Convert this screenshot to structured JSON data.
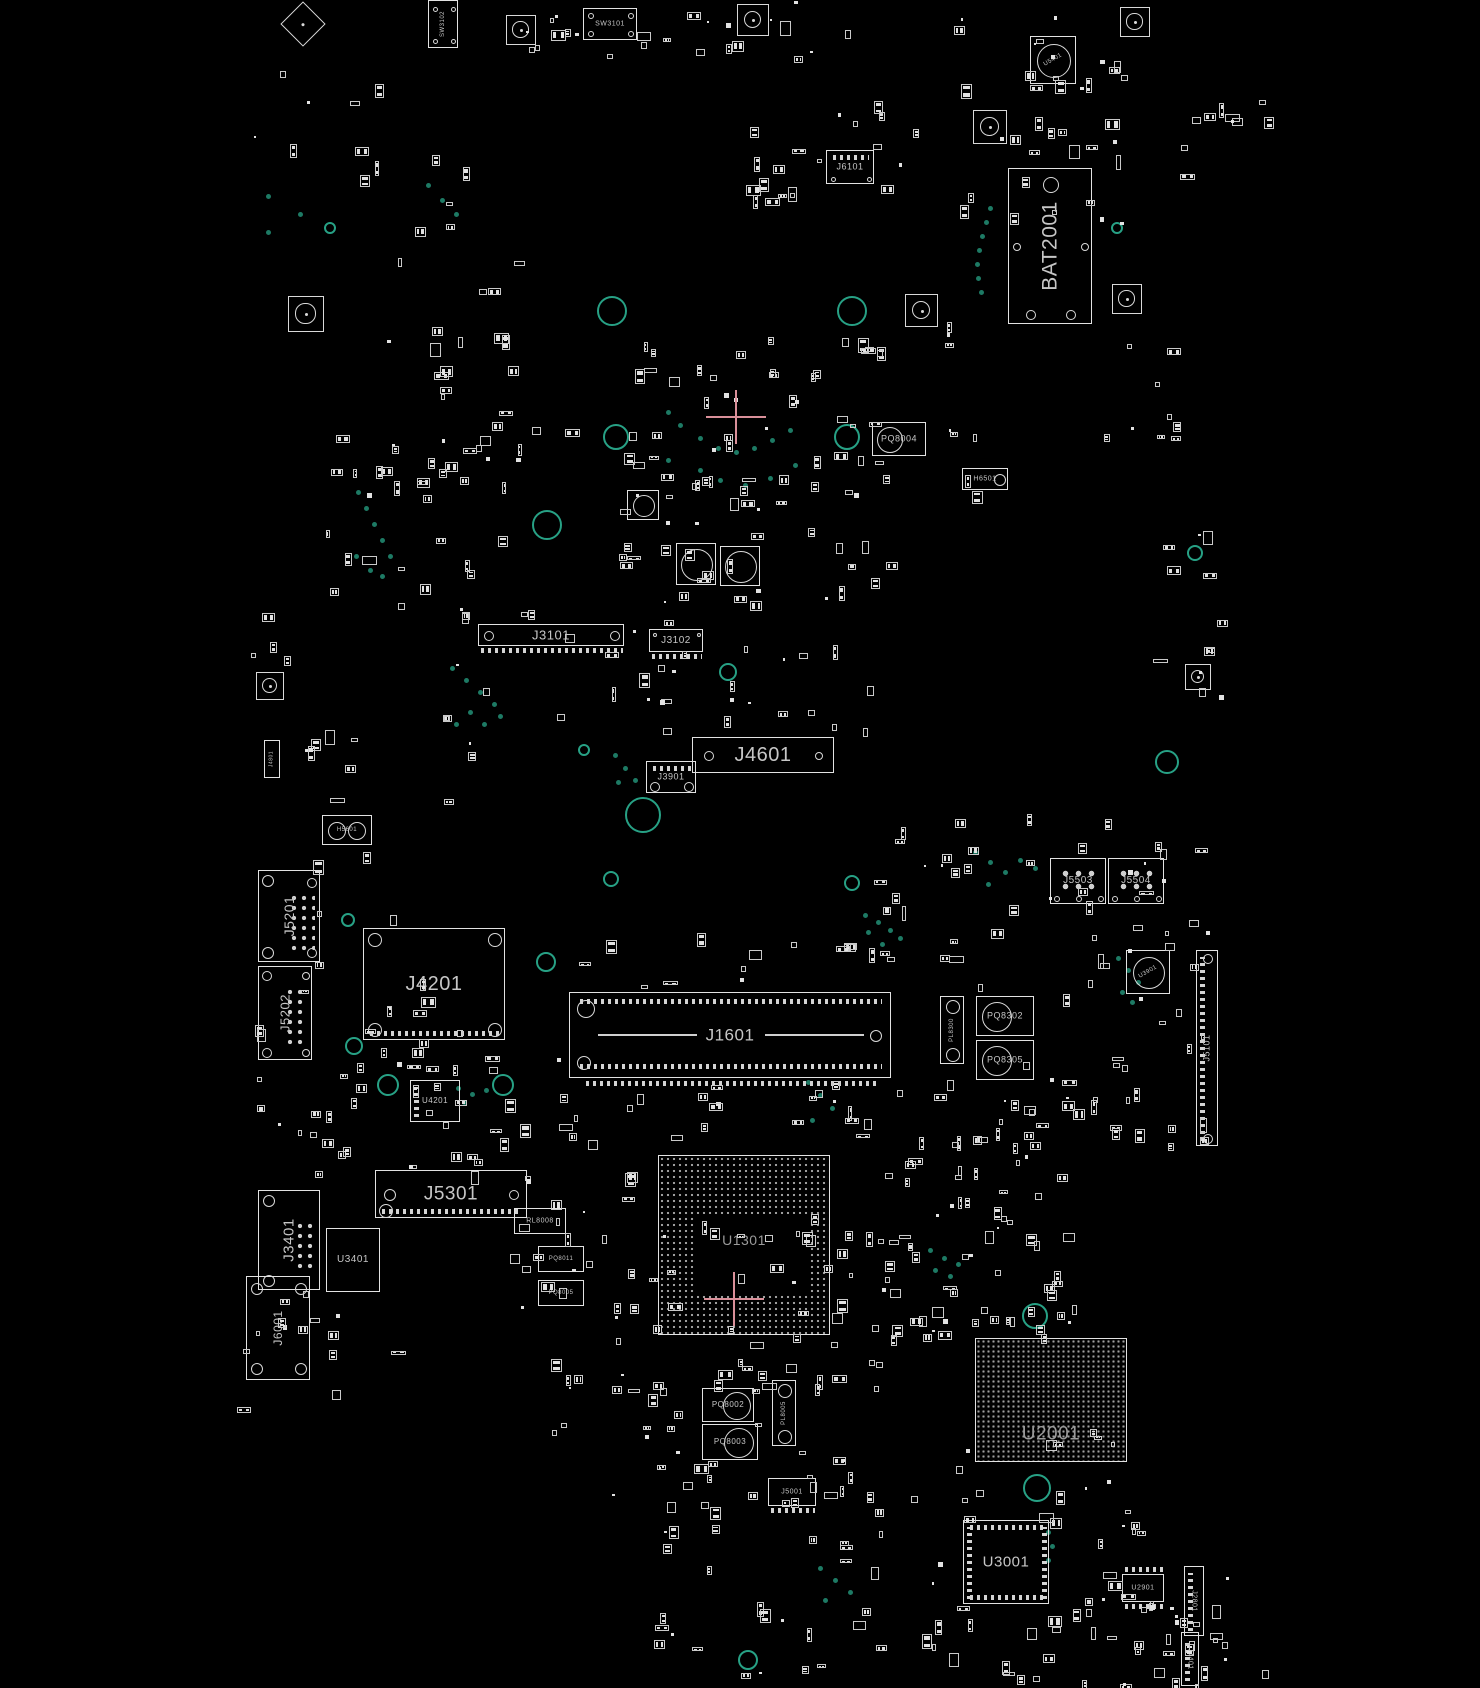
{
  "view": {
    "description": "PCB boardview component placement diagram, black background with white component outlines",
    "width": 1480,
    "height": 1688
  },
  "colors": {
    "background": "#000000",
    "outline": "#e2e2e2",
    "label": "#c6c6c6",
    "label_dim": "#9a9a9a",
    "via_teal": "#1d7a64",
    "ring_teal": "#27a185",
    "bga_dot": "#9f9f9f",
    "crosshair_pink": "#d98f99"
  },
  "components": [
    {
      "label": "SW3102",
      "x": 428,
      "y": 0,
      "w": 30,
      "h": 48,
      "fs": 6,
      "rot": -90,
      "holes": [
        [
          6,
          8,
          2.5
        ],
        [
          24,
          8,
          2.5
        ],
        [
          6,
          40,
          2.5
        ],
        [
          24,
          40,
          2.5
        ]
      ]
    },
    {
      "label": "SW3101",
      "x": 583,
      "y": 8,
      "w": 54,
      "h": 32,
      "fs": 7,
      "rot": 0,
      "holes": [
        [
          7,
          7,
          3
        ],
        [
          47,
          7,
          3
        ],
        [
          7,
          25,
          3
        ],
        [
          47,
          25,
          3
        ]
      ]
    },
    {
      "label": "J6101",
      "x": 826,
      "y": 150,
      "w": 48,
      "h": 34,
      "fs": 9,
      "rot": 0,
      "pins": [
        "top"
      ],
      "holes": [
        [
          6,
          28,
          2.5
        ],
        [
          42,
          28,
          2.5
        ]
      ]
    },
    {
      "label": "U5401",
      "x": 1030,
      "y": 36,
      "w": 46,
      "h": 48,
      "fs": 6,
      "rot": -30,
      "circles": [
        [
          23,
          24,
          17
        ]
      ]
    },
    {
      "label": "BAT2001",
      "x": 1008,
      "y": 168,
      "w": 84,
      "h": 156,
      "fs": 21,
      "rot": -90,
      "holes": [
        [
          42,
          16,
          8
        ],
        [
          8,
          78,
          4
        ],
        [
          76,
          78,
          4
        ],
        [
          22,
          146,
          5
        ],
        [
          62,
          146,
          5
        ]
      ]
    },
    {
      "label": "PQ8004",
      "x": 872,
      "y": 422,
      "w": 54,
      "h": 34,
      "fs": 9,
      "rot": 0,
      "circles": [
        [
          17,
          17,
          13
        ]
      ]
    },
    {
      "label": "H6501",
      "x": 962,
      "y": 468,
      "w": 46,
      "h": 22,
      "fs": 7,
      "rot": 0,
      "circles": [
        [
          37,
          11,
          6
        ]
      ]
    },
    {
      "label": "J3101",
      "x": 478,
      "y": 624,
      "w": 146,
      "h": 22,
      "fs": 13,
      "rot": 0,
      "holes": [
        [
          10,
          11,
          5
        ],
        [
          136,
          11,
          5
        ]
      ],
      "pins": [
        "bottom-out"
      ]
    },
    {
      "label": "J3102",
      "x": 649,
      "y": 629,
      "w": 54,
      "h": 23,
      "fs": 10,
      "rot": 0,
      "pins": [
        "bottom-out"
      ],
      "holes": [
        [
          5,
          5,
          2
        ],
        [
          49,
          5,
          2
        ]
      ]
    },
    {
      "label": "J4601",
      "x": 692,
      "y": 737,
      "w": 142,
      "h": 36,
      "fs": 20,
      "rot": 0,
      "holes": [
        [
          16,
          18,
          5
        ],
        [
          126,
          18,
          4
        ]
      ]
    },
    {
      "label": "J3901",
      "x": 646,
      "y": 761,
      "w": 50,
      "h": 32,
      "fs": 9,
      "rot": 0,
      "pins": [
        "top"
      ],
      "holes": [
        [
          8,
          25,
          5
        ],
        [
          42,
          25,
          5
        ]
      ]
    },
    {
      "label": "H5601",
      "x": 322,
      "y": 815,
      "w": 50,
      "h": 30,
      "fs": 6,
      "rot": 0,
      "circles": [
        [
          14,
          15,
          9
        ],
        [
          34,
          15,
          9
        ]
      ]
    },
    {
      "label": "J5201",
      "x": 258,
      "y": 870,
      "w": 62,
      "h": 92,
      "fs": 14,
      "rot": -90,
      "holes": [
        [
          9,
          10,
          6
        ],
        [
          53,
          12,
          5
        ],
        [
          9,
          82,
          6
        ],
        [
          53,
          82,
          5
        ]
      ],
      "dots": [
        30,
        22,
        26,
        58,
        10,
        2
      ]
    },
    {
      "label": "J5202",
      "x": 258,
      "y": 966,
      "w": 54,
      "h": 94,
      "fs": 13,
      "rot": -90,
      "holes": [
        [
          8,
          9,
          5
        ],
        [
          47,
          9,
          4
        ],
        [
          8,
          86,
          5
        ],
        [
          47,
          86,
          4
        ]
      ],
      "dots": [
        26,
        20,
        22,
        60,
        10,
        2
      ]
    },
    {
      "label": "J4201",
      "x": 363,
      "y": 928,
      "w": 142,
      "h": 112,
      "fs": 20,
      "rot": 0,
      "holes": [
        [
          11,
          11,
          7
        ],
        [
          131,
          11,
          7
        ],
        [
          11,
          101,
          7
        ],
        [
          131,
          101,
          7
        ]
      ],
      "pins": [
        "bottom"
      ]
    },
    {
      "label": "U4201",
      "x": 410,
      "y": 1080,
      "w": 50,
      "h": 42,
      "fs": 8,
      "rot": 0,
      "pins": [
        "left"
      ]
    },
    {
      "label": "J1601",
      "x": 569,
      "y": 992,
      "w": 322,
      "h": 86,
      "fs": 17,
      "rot": 0,
      "kind": "dimm",
      "holes": [
        [
          16,
          16,
          9
        ],
        [
          306,
          43,
          6
        ],
        [
          14,
          70,
          7
        ]
      ]
    },
    {
      "label": "J5503",
      "x": 1050,
      "y": 858,
      "w": 56,
      "h": 46,
      "fs": 10,
      "rot": 0,
      "dots": [
        8,
        8,
        40,
        26,
        13,
        2.6
      ],
      "holes": [
        [
          6,
          40,
          3
        ],
        [
          28,
          40,
          3
        ],
        [
          50,
          40,
          3
        ]
      ]
    },
    {
      "label": "J5504",
      "x": 1108,
      "y": 858,
      "w": 56,
      "h": 46,
      "fs": 10,
      "rot": 0,
      "dots": [
        8,
        8,
        40,
        26,
        13,
        2.6
      ],
      "holes": [
        [
          6,
          40,
          3
        ],
        [
          28,
          40,
          3
        ],
        [
          50,
          40,
          3
        ]
      ]
    },
    {
      "label": "U3901",
      "x": 1126,
      "y": 950,
      "w": 44,
      "h": 44,
      "fs": 6,
      "rot": -30,
      "circles": [
        [
          22,
          22,
          16
        ]
      ]
    },
    {
      "label": "PL8300",
      "x": 940,
      "y": 996,
      "w": 24,
      "h": 68,
      "fs": 6,
      "rot": -90,
      "circles": [
        [
          12,
          10,
          7
        ],
        [
          12,
          58,
          7
        ]
      ]
    },
    {
      "label": "PQ8302",
      "x": 976,
      "y": 996,
      "w": 58,
      "h": 40,
      "fs": 9,
      "rot": 0,
      "circles": [
        [
          20,
          20,
          15
        ]
      ]
    },
    {
      "label": "PQ8305",
      "x": 976,
      "y": 1040,
      "w": 58,
      "h": 40,
      "fs": 9,
      "rot": 0,
      "circles": [
        [
          20,
          20,
          15
        ]
      ]
    },
    {
      "label": "J5101",
      "x": 1196,
      "y": 950,
      "w": 22,
      "h": 196,
      "fs": 9,
      "rot": -90,
      "holes": [
        [
          11,
          8,
          5
        ],
        [
          11,
          188,
          5
        ]
      ],
      "pins": [
        "left"
      ]
    },
    {
      "label": "J5301",
      "x": 375,
      "y": 1170,
      "w": 152,
      "h": 48,
      "fs": 19,
      "rot": 0,
      "holes": [
        [
          14,
          24,
          6
        ],
        [
          138,
          24,
          5
        ],
        [
          10,
          40,
          7
        ]
      ],
      "pins": [
        "bottom"
      ]
    },
    {
      "label": "RL8008",
      "x": 514,
      "y": 1208,
      "w": 52,
      "h": 26,
      "fs": 7,
      "rot": 0
    },
    {
      "label": "PQ8011",
      "x": 538,
      "y": 1246,
      "w": 46,
      "h": 26,
      "fs": 6,
      "rot": 0
    },
    {
      "label": "PQ8005",
      "x": 538,
      "y": 1280,
      "w": 46,
      "h": 26,
      "fs": 6,
      "rot": 0
    },
    {
      "label": "J3401",
      "x": 258,
      "y": 1190,
      "w": 62,
      "h": 100,
      "fs": 15,
      "rot": -90,
      "holes": [
        [
          10,
          10,
          6
        ],
        [
          10,
          90,
          6
        ]
      ],
      "dots": [
        36,
        30,
        20,
        50,
        10,
        2
      ]
    },
    {
      "label": "U3401",
      "x": 326,
      "y": 1228,
      "w": 54,
      "h": 64,
      "fs": 10,
      "rot": 0
    },
    {
      "label": "J6001",
      "x": 246,
      "y": 1276,
      "w": 64,
      "h": 104,
      "fs": 12,
      "rot": -90,
      "holes": [
        [
          10,
          12,
          6
        ],
        [
          54,
          12,
          6
        ],
        [
          10,
          92,
          6
        ],
        [
          54,
          92,
          6
        ]
      ]
    },
    {
      "label": "U1301",
      "x": 658,
      "y": 1155,
      "w": 172,
      "h": 180,
      "fs": 14,
      "rot": 0,
      "kind": "bga1"
    },
    {
      "label": "U2001",
      "x": 975,
      "y": 1338,
      "w": 152,
      "h": 124,
      "fs": 19,
      "rot": 0,
      "kind": "bga2"
    },
    {
      "label": "U3001",
      "x": 963,
      "y": 1520,
      "w": 86,
      "h": 84,
      "fs": 15,
      "rot": 0,
      "pins": [
        "top",
        "bottom",
        "left",
        "right"
      ]
    },
    {
      "label": "PQ8002",
      "x": 702,
      "y": 1388,
      "w": 52,
      "h": 34,
      "fs": 8,
      "rot": 0,
      "circles": [
        [
          34,
          17,
          14
        ]
      ]
    },
    {
      "label": "PQ8003",
      "x": 702,
      "y": 1424,
      "w": 56,
      "h": 36,
      "fs": 8,
      "rot": 0,
      "circles": [
        [
          36,
          18,
          15
        ]
      ]
    },
    {
      "label": "PL8005",
      "x": 772,
      "y": 1380,
      "w": 24,
      "h": 66,
      "fs": 6,
      "rot": -90,
      "circles": [
        [
          12,
          10,
          7
        ],
        [
          12,
          56,
          7
        ]
      ]
    },
    {
      "label": "J5001",
      "x": 768,
      "y": 1478,
      "w": 48,
      "h": 28,
      "fs": 7,
      "rot": 0,
      "pins": [
        "bottom-out"
      ]
    },
    {
      "label": "U2901",
      "x": 1122,
      "y": 1574,
      "w": 42,
      "h": 28,
      "fs": 7,
      "rot": 0,
      "pins": [
        "top-out",
        "bottom-out"
      ]
    },
    {
      "label": "J2801",
      "x": 1184,
      "y": 1566,
      "w": 20,
      "h": 70,
      "fs": 7,
      "rot": 90,
      "pins": [
        "left"
      ]
    },
    {
      "label": "J4401",
      "x": 1181,
      "y": 1632,
      "w": 18,
      "h": 54,
      "fs": 7,
      "rot": 90,
      "pins": [
        "left"
      ]
    },
    {
      "label": "J4801",
      "x": 264,
      "y": 740,
      "w": 16,
      "h": 38,
      "fs": 5,
      "rot": -90
    },
    {
      "label": "",
      "x": 676,
      "y": 543,
      "w": 40,
      "h": 42,
      "circles": [
        [
          20,
          21,
          16
        ]
      ]
    },
    {
      "label": "",
      "x": 720,
      "y": 546,
      "w": 40,
      "h": 40,
      "circles": [
        [
          20,
          20,
          16
        ]
      ]
    },
    {
      "label": "",
      "x": 627,
      "y": 490,
      "w": 32,
      "h": 30,
      "circles": [
        [
          16,
          15,
          11
        ]
      ]
    }
  ],
  "passive_clusters": [
    [
      520,
      0,
      330,
      58,
      24
    ],
    [
      735,
      95,
      190,
      108,
      20
    ],
    [
      938,
      14,
      185,
      212,
      36
    ],
    [
      1150,
      75,
      130,
      108,
      10
    ],
    [
      380,
      255,
      150,
      95,
      10
    ],
    [
      425,
      360,
      145,
      135,
      14
    ],
    [
      320,
      430,
      200,
      175,
      30
    ],
    [
      615,
      325,
      268,
      182,
      42
    ],
    [
      610,
      458,
      280,
      148,
      38
    ],
    [
      855,
      320,
      128,
      178,
      12
    ],
    [
      1085,
      335,
      95,
      135,
      9
    ],
    [
      1148,
      470,
      72,
      230,
      12
    ],
    [
      430,
      600,
      238,
      128,
      18
    ],
    [
      635,
      642,
      238,
      98,
      18
    ],
    [
      280,
      710,
      198,
      98,
      10
    ],
    [
      295,
      830,
      128,
      208,
      8
    ],
    [
      868,
      810,
      340,
      188,
      48
    ],
    [
      1090,
      1000,
      118,
      158,
      18
    ],
    [
      235,
      990,
      228,
      188,
      28
    ],
    [
      335,
      1050,
      238,
      128,
      20
    ],
    [
      510,
      1090,
      158,
      218,
      24
    ],
    [
      795,
      1050,
      278,
      278,
      52
    ],
    [
      550,
      1222,
      128,
      216,
      20
    ],
    [
      610,
      1322,
      278,
      208,
      40
    ],
    [
      868,
      1226,
      208,
      118,
      28
    ],
    [
      1030,
      1420,
      158,
      198,
      20
    ],
    [
      830,
      1440,
      148,
      218,
      26
    ],
    [
      946,
      1598,
      318,
      86,
      28
    ],
    [
      650,
      1460,
      168,
      224,
      24
    ],
    [
      235,
      1280,
      168,
      128,
      14
    ],
    [
      1082,
      1560,
      150,
      124,
      16
    ],
    [
      240,
      60,
      140,
      118,
      7
    ],
    [
      355,
      120,
      118,
      118,
      7
    ],
    [
      1010,
      1060,
      78,
      98,
      8
    ],
    [
      878,
      1128,
      118,
      88,
      12
    ],
    [
      250,
      598,
      44,
      80,
      4
    ],
    [
      560,
      930,
      320,
      56,
      14
    ],
    [
      640,
      1085,
      240,
      58,
      12
    ],
    [
      700,
      1218,
      112,
      70,
      9
    ]
  ],
  "vias": [
    [
      990,
      208
    ],
    [
      986,
      222
    ],
    [
      982,
      236
    ],
    [
      979,
      250
    ],
    [
      977,
      264
    ],
    [
      978,
      278
    ],
    [
      981,
      292
    ],
    [
      268,
      196
    ],
    [
      268,
      232
    ],
    [
      300,
      214
    ],
    [
      428,
      185
    ],
    [
      442,
      200
    ],
    [
      456,
      214
    ],
    [
      668,
      412
    ],
    [
      680,
      425
    ],
    [
      700,
      438
    ],
    [
      718,
      448
    ],
    [
      736,
      452
    ],
    [
      754,
      448
    ],
    [
      772,
      440
    ],
    [
      790,
      430
    ],
    [
      700,
      470
    ],
    [
      720,
      480
    ],
    [
      745,
      485
    ],
    [
      770,
      478
    ],
    [
      668,
      460
    ],
    [
      795,
      465
    ],
    [
      358,
      492
    ],
    [
      366,
      508
    ],
    [
      374,
      524
    ],
    [
      382,
      540
    ],
    [
      390,
      556
    ],
    [
      370,
      570
    ],
    [
      356,
      556
    ],
    [
      382,
      576
    ],
    [
      452,
      668
    ],
    [
      466,
      680
    ],
    [
      480,
      692
    ],
    [
      494,
      704
    ],
    [
      470,
      712
    ],
    [
      456,
      724
    ],
    [
      484,
      724
    ],
    [
      500,
      716
    ],
    [
      615,
      755
    ],
    [
      625,
      768
    ],
    [
      635,
      780
    ],
    [
      618,
      782
    ],
    [
      975,
      852
    ],
    [
      990,
      862
    ],
    [
      1005,
      872
    ],
    [
      1020,
      860
    ],
    [
      1035,
      868
    ],
    [
      988,
      884
    ],
    [
      865,
      915
    ],
    [
      878,
      922
    ],
    [
      890,
      930
    ],
    [
      900,
      938
    ],
    [
      868,
      932
    ],
    [
      882,
      944
    ],
    [
      458,
      1088
    ],
    [
      472,
      1094
    ],
    [
      486,
      1090
    ],
    [
      464,
      1102
    ],
    [
      930,
      1250
    ],
    [
      944,
      1258
    ],
    [
      958,
      1264
    ],
    [
      935,
      1270
    ],
    [
      950,
      1276
    ],
    [
      1048,
      1532
    ],
    [
      1052,
      1546
    ],
    [
      1048,
      1560
    ],
    [
      820,
      1568
    ],
    [
      835,
      1580
    ],
    [
      850,
      1592
    ],
    [
      825,
      1600
    ],
    [
      1118,
      958
    ],
    [
      1128,
      970
    ],
    [
      1138,
      982
    ],
    [
      1122,
      992
    ],
    [
      1132,
      1002
    ],
    [
      808,
      1082
    ],
    [
      820,
      1095
    ],
    [
      832,
      1108
    ],
    [
      812,
      1120
    ]
  ],
  "rings": [
    [
      612,
      311,
      15
    ],
    [
      852,
      311,
      15
    ],
    [
      616,
      437,
      13
    ],
    [
      847,
      437,
      13
    ],
    [
      547,
      525,
      15
    ],
    [
      643,
      815,
      18
    ],
    [
      728,
      672,
      9
    ],
    [
      1167,
      762,
      12
    ],
    [
      611,
      879,
      8
    ],
    [
      852,
      883,
      8
    ],
    [
      546,
      962,
      10
    ],
    [
      354,
      1046,
      9
    ],
    [
      388,
      1085,
      11
    ],
    [
      503,
      1085,
      11
    ],
    [
      1035,
      1316,
      13
    ],
    [
      1037,
      1488,
      14
    ],
    [
      748,
      1660,
      10
    ],
    [
      330,
      228,
      6
    ],
    [
      1117,
      228,
      6
    ],
    [
      584,
      750,
      6
    ],
    [
      348,
      920,
      7
    ],
    [
      1195,
      553,
      8
    ]
  ],
  "mounts": [
    [
      506,
      15,
      30
    ],
    [
      737,
      4,
      32
    ],
    [
      1120,
      7,
      30
    ],
    [
      973,
      110,
      34
    ],
    [
      905,
      294,
      33
    ],
    [
      1112,
      284,
      30
    ],
    [
      288,
      296,
      36
    ],
    [
      256,
      672,
      28
    ],
    [
      1185,
      664,
      26
    ]
  ],
  "fiducial_diamond": [
    287,
    8,
    32
  ],
  "crosshairs": [
    [
      736,
      417
    ],
    [
      734,
      1299
    ]
  ]
}
